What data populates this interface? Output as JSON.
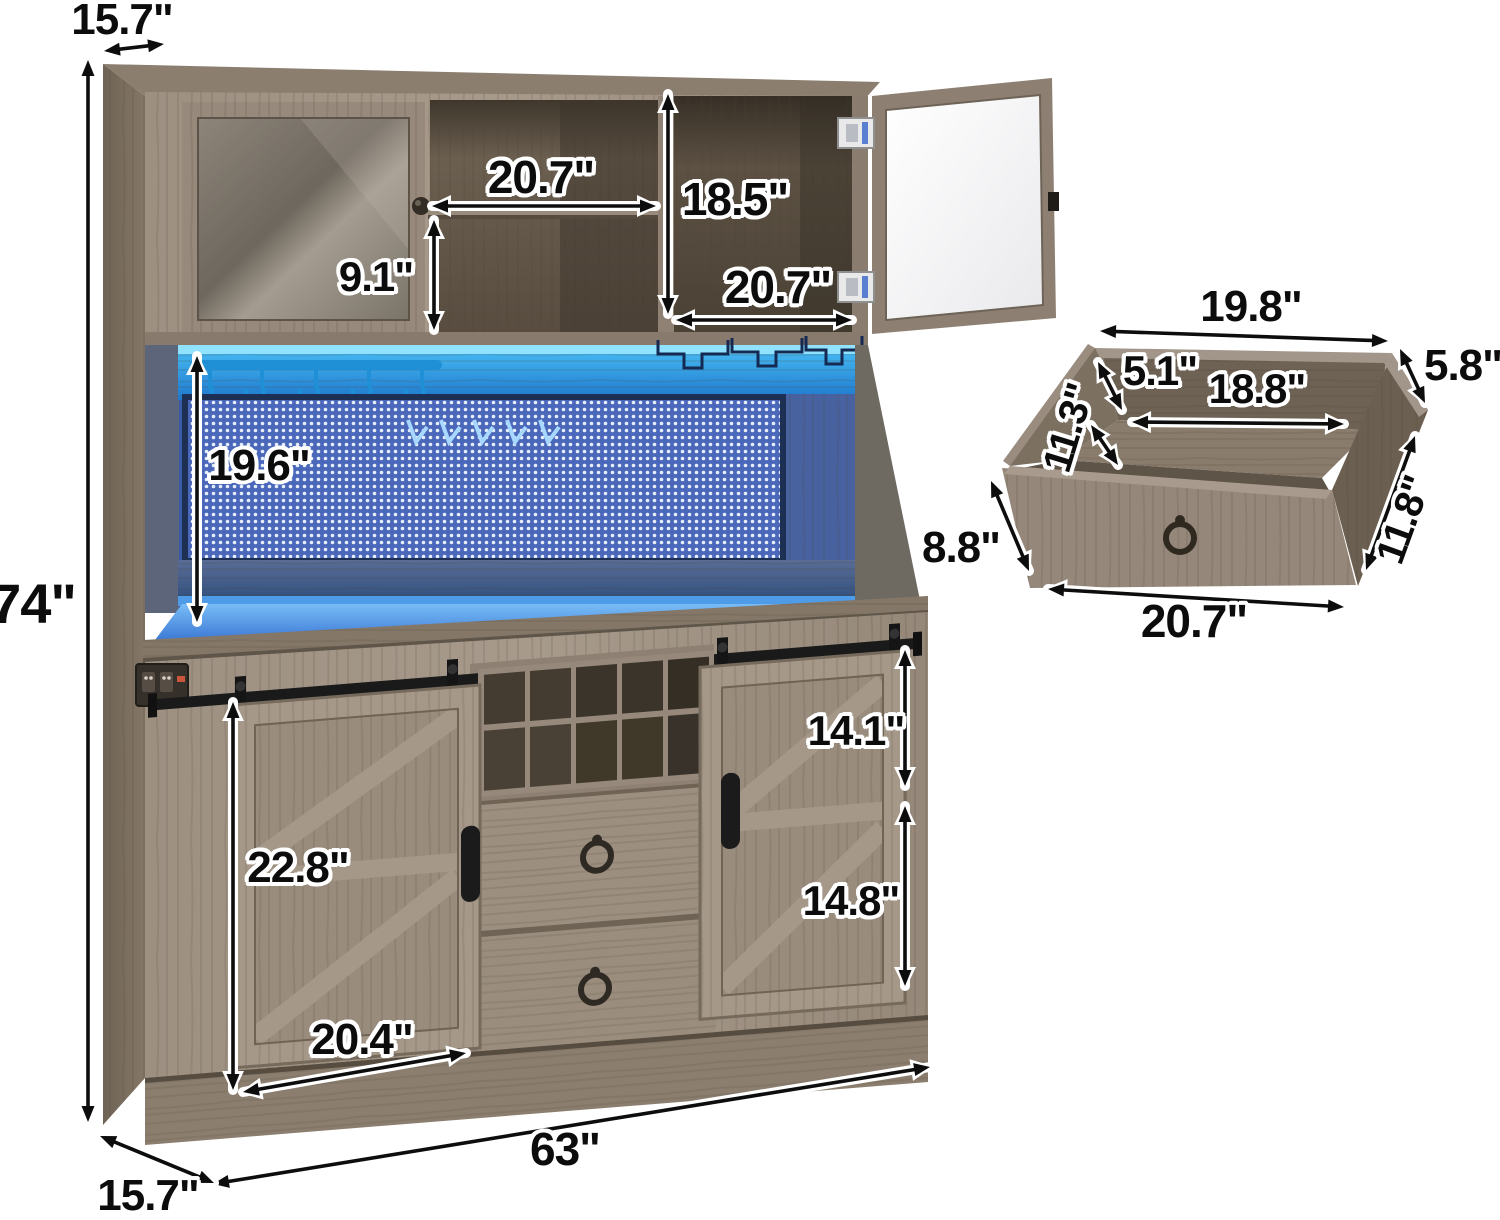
{
  "dimensions": {
    "top_depth": "15.7\"",
    "overall_height": "74\"",
    "hutch_shelf_width": "20.7\"",
    "hutch_cabinet_height": "18.5\"",
    "hutch_shelf_height": "9.1\"",
    "hutch_right_cabinet_width": "20.7\"",
    "hutch_open_height": "19.6\"",
    "door_height": "22.8\"",
    "right_top_section_height": "14.1\"",
    "right_bottom_section_height": "14.8\"",
    "door_width": "20.4\"",
    "overall_width": "63\"",
    "base_depth": "15.7\""
  },
  "drawer": {
    "top_width": "19.8\"",
    "wall_height": "5.8\"",
    "inner_height": "5.1\"",
    "inner_width": "18.8\"",
    "inner_depth": "11.3\"",
    "outer_depth": "11.8\"",
    "front_height": "8.8\"",
    "front_width": "20.7\""
  }
}
